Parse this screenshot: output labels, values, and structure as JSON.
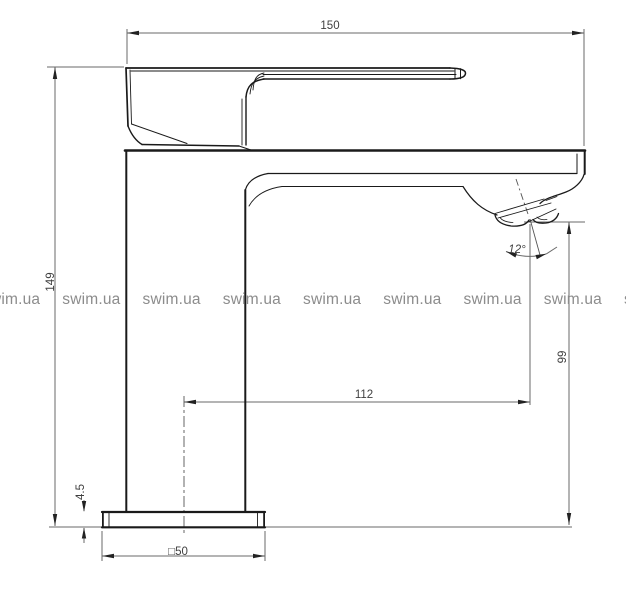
{
  "drawing": {
    "title": "faucet-side-view-technical-drawing",
    "line_color": "#1a1a1a",
    "dimension_line_color": "#6a6a6a",
    "background": "#ffffff"
  },
  "dimensions": {
    "total_width": "150",
    "total_height": "149",
    "spout_reach": "112",
    "spout_height": "99",
    "base_plate_thickness": "4.5",
    "base_plate_size": "□50",
    "spray_angle": "12°"
  },
  "watermark": {
    "text": "swim.ua",
    "color": "#8c8c8c"
  }
}
